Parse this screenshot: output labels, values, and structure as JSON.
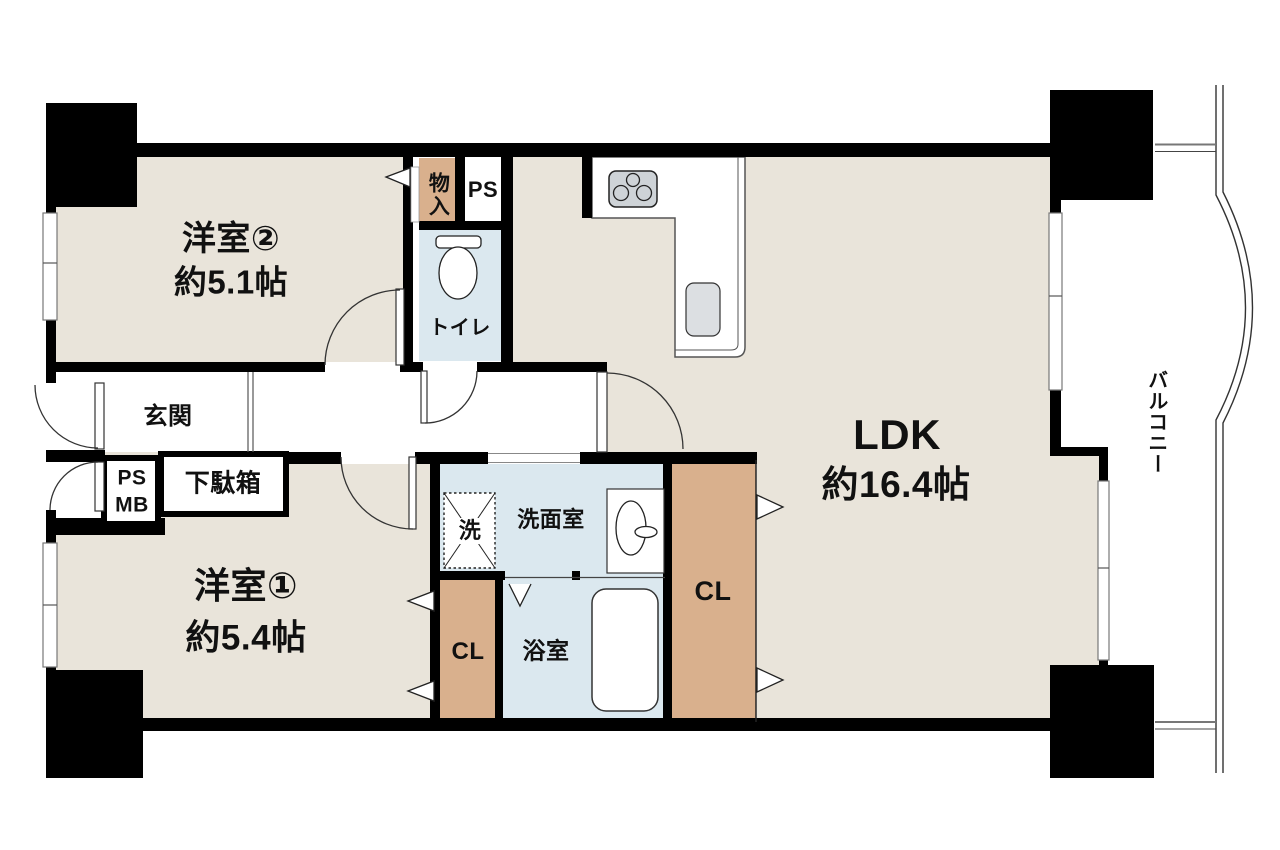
{
  "plan": {
    "type": "apartment-floorplan",
    "rooms": {
      "western2": {
        "name": "洋室②",
        "size": "約5.1帖"
      },
      "western1": {
        "name": "洋室①",
        "size": "約5.4帖"
      },
      "ldk": {
        "name": "LDK",
        "size": "約16.4帖"
      },
      "entrance": {
        "name": "玄関"
      },
      "shoe_cabinet": {
        "name": "下駄箱"
      },
      "meter_box": {
        "line1": "PS",
        "line2": "MB"
      },
      "storage": {
        "name": "物入"
      },
      "pipe_space": {
        "name": "PS"
      },
      "toilet": {
        "name": "トイレ"
      },
      "washroom": {
        "name": "洗面室"
      },
      "washer": {
        "name": "洗"
      },
      "bathroom": {
        "name": "浴室"
      },
      "closet_left": {
        "name": "CL"
      },
      "closet_right": {
        "name": "CL"
      },
      "balcony": {
        "name": "バルコニー"
      }
    },
    "colors": {
      "wall": "#000000",
      "room_floor": "#e9e4da",
      "wet_floor": "#dbe8ef",
      "closet_floor": "#d9b08d",
      "fixture_gray": "#ced3d7",
      "outline": "#333333",
      "background": "#ffffff"
    }
  }
}
